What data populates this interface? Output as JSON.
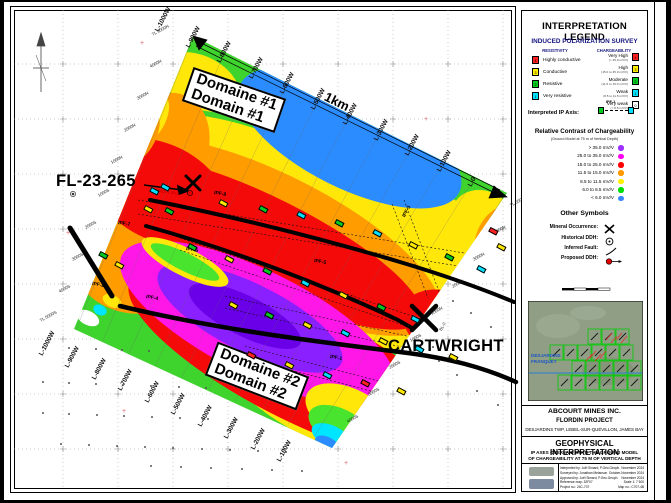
{
  "map": {
    "labels": {
      "drillhole": "FL-23-265",
      "cartwright": "CARTWRIGHT",
      "occurrence": "FLORDIN (Au)",
      "scale": "1km",
      "baseline": "BL-0",
      "domain1": {
        "line1": "Domaine #1",
        "line2": "Domain #1"
      },
      "domain2": {
        "line1": "Domaine #2",
        "line2": "Domain #2"
      }
    },
    "lines_top": [
      {
        "t": "L-1000W",
        "x": 160,
        "y": 26
      },
      {
        "t": "L-900W",
        "x": 191,
        "y": 42
      },
      {
        "t": "L-800W",
        "x": 222,
        "y": 57
      },
      {
        "t": "L-700W",
        "x": 254,
        "y": 73
      },
      {
        "t": "L-600W",
        "x": 285,
        "y": 88
      },
      {
        "t": "L-500W",
        "x": 316,
        "y": 104
      },
      {
        "t": "L-400W",
        "x": 348,
        "y": 119
      },
      {
        "t": "L-300W",
        "x": 379,
        "y": 135
      },
      {
        "t": "L-200W",
        "x": 410,
        "y": 150
      },
      {
        "t": "L-100W",
        "x": 442,
        "y": 166
      },
      {
        "t": "L-0",
        "x": 473,
        "y": 181
      }
    ],
    "lines_bottom": [
      {
        "t": "L-1000W",
        "x": 44,
        "y": 350
      },
      {
        "t": "L-900W",
        "x": 70,
        "y": 362
      },
      {
        "t": "L-800W",
        "x": 97,
        "y": 374
      },
      {
        "t": "L-700W",
        "x": 123,
        "y": 385
      },
      {
        "t": "L-600W",
        "x": 150,
        "y": 397
      },
      {
        "t": "L-500W",
        "x": 176,
        "y": 409
      },
      {
        "t": "L-400W",
        "x": 203,
        "y": 421
      },
      {
        "t": "L-300W",
        "x": 229,
        "y": 433
      },
      {
        "t": "L-200W",
        "x": 256,
        "y": 444
      },
      {
        "t": "L-100W",
        "x": 282,
        "y": 456
      }
    ],
    "stations_west": [
      {
        "t": "TL 5000N",
        "x": 152,
        "y": 32
      },
      {
        "t": "4000N",
        "x": 150,
        "y": 64
      },
      {
        "t": "3000N",
        "x": 137,
        "y": 96
      },
      {
        "t": "2000N",
        "x": 124,
        "y": 128
      },
      {
        "t": "1000N",
        "x": 111,
        "y": 160
      },
      {
        "t": "1000S",
        "x": 98,
        "y": 193
      },
      {
        "t": "2000S",
        "x": 85,
        "y": 225
      },
      {
        "t": "3000S",
        "x": 72,
        "y": 257
      },
      {
        "t": "4000S",
        "x": 59,
        "y": 289
      },
      {
        "t": "TL 5000S",
        "x": 40,
        "y": 318
      }
    ],
    "stations_east": [
      {
        "t": "TL 5000N",
        "x": 510,
        "y": 203
      },
      {
        "t": "4000N",
        "x": 494,
        "y": 230
      },
      {
        "t": "3000N",
        "x": 473,
        "y": 257
      },
      {
        "t": "2000N",
        "x": 452,
        "y": 284
      },
      {
        "t": "1000N",
        "x": 431,
        "y": 311
      },
      {
        "t": "1000S",
        "x": 410,
        "y": 338
      },
      {
        "t": "2000S",
        "x": 389,
        "y": 365
      },
      {
        "t": "3000S",
        "x": 368,
        "y": 392
      },
      {
        "t": "4000S",
        "x": 347,
        "y": 419
      }
    ],
    "ipf_labels": [
      {
        "t": "IPF-8",
        "x": 214,
        "y": 190,
        "r": 10
      },
      {
        "t": "IPF-7",
        "x": 118,
        "y": 220,
        "r": 10
      },
      {
        "t": "IPF-6",
        "x": 186,
        "y": 246,
        "r": 10
      },
      {
        "t": "IPF-5",
        "x": 314,
        "y": 258,
        "r": 10
      },
      {
        "t": "IPF-4",
        "x": 146,
        "y": 294,
        "r": 10
      },
      {
        "t": "IPF-3",
        "x": 404,
        "y": 214,
        "r": -62
      },
      {
        "t": "IPF-2",
        "x": 92,
        "y": 281,
        "r": 10
      },
      {
        "t": "IPF-1",
        "x": 330,
        "y": 354,
        "r": 10
      }
    ],
    "chip_colors": {
      "g": "#00CC22",
      "c": "#00E0FF",
      "y": "#FFEA00",
      "r": "#FF2222"
    },
    "chips": [
      [
        152,
        187,
        "c"
      ],
      [
        163,
        183,
        "c"
      ],
      [
        146,
        205,
        "y"
      ],
      [
        167,
        207,
        "g"
      ],
      [
        221,
        199,
        "y"
      ],
      [
        261,
        205,
        "g"
      ],
      [
        299,
        211,
        "c"
      ],
      [
        337,
        219,
        "g"
      ],
      [
        375,
        229,
        "c"
      ],
      [
        411,
        241,
        "y"
      ],
      [
        447,
        253,
        "g"
      ],
      [
        479,
        265,
        "c"
      ],
      [
        190,
        243,
        "g"
      ],
      [
        227,
        255,
        "y"
      ],
      [
        265,
        267,
        "g"
      ],
      [
        303,
        279,
        "c"
      ],
      [
        341,
        291,
        "y"
      ],
      [
        379,
        303,
        "g"
      ],
      [
        413,
        315,
        "c"
      ],
      [
        231,
        301,
        "y"
      ],
      [
        267,
        311,
        "g"
      ],
      [
        305,
        321,
        "y"
      ],
      [
        343,
        329,
        "c"
      ],
      [
        381,
        337,
        "y"
      ],
      [
        417,
        345,
        "c"
      ],
      [
        451,
        353,
        "y"
      ],
      [
        249,
        351,
        "r"
      ],
      [
        287,
        361,
        "y"
      ],
      [
        325,
        371,
        "c"
      ],
      [
        363,
        379,
        "r"
      ],
      [
        399,
        387,
        "y"
      ],
      [
        491,
        227,
        "r"
      ],
      [
        499,
        243,
        "y"
      ],
      [
        117,
        261,
        "y"
      ],
      [
        101,
        251,
        "g"
      ]
    ],
    "ddh_dots": [
      [
        42,
        346
      ],
      [
        68,
        347
      ],
      [
        95,
        348
      ],
      [
        121,
        349
      ],
      [
        148,
        350
      ],
      [
        42,
        381
      ],
      [
        68,
        382
      ],
      [
        95,
        383
      ],
      [
        122,
        384
      ],
      [
        150,
        385
      ],
      [
        178,
        386
      ],
      [
        205,
        387
      ],
      [
        42,
        412
      ],
      [
        68,
        413
      ],
      [
        96,
        414
      ],
      [
        123,
        415
      ],
      [
        151,
        416
      ],
      [
        179,
        417
      ],
      [
        207,
        418
      ],
      [
        234,
        419
      ],
      [
        60,
        443
      ],
      [
        88,
        444
      ],
      [
        116,
        445
      ],
      [
        144,
        446
      ],
      [
        172,
        447
      ],
      [
        201,
        448
      ],
      [
        229,
        449
      ],
      [
        257,
        450
      ],
      [
        285,
        451
      ],
      [
        150,
        465
      ],
      [
        180,
        466
      ],
      [
        210,
        467
      ],
      [
        241,
        468
      ],
      [
        271,
        469
      ],
      [
        301,
        470
      ],
      [
        438,
        360
      ],
      [
        456,
        374
      ],
      [
        476,
        390
      ],
      [
        497,
        404
      ],
      [
        432,
        346
      ],
      [
        452,
        300
      ],
      [
        470,
        312
      ],
      [
        490,
        326
      ]
    ],
    "red_crosses": [
      [
        140,
        42
      ],
      [
        424,
        118
      ],
      [
        66,
        232
      ],
      [
        122,
        410
      ],
      [
        344,
        462
      ]
    ]
  },
  "legend": {
    "title": "INTERPRETATION LEGEND",
    "ip_survey": {
      "heading": "INDUCED POLARIZATION SURVEY",
      "col_resistivity": "RESISTIVITY",
      "col_chargeability": "CHARGEABILITY",
      "resistivity": [
        {
          "code": "4",
          "color": "#FF2020",
          "label": "Highly conductive"
        },
        {
          "code": "3",
          "color": "#FFEE00",
          "label": "Conductive"
        },
        {
          "code": "2",
          "color": "#00CC22",
          "label": "Resistive"
        },
        {
          "code": "1",
          "color": "#00E0FF",
          "label": "Very resistive"
        }
      ],
      "chargeability": [
        {
          "code": "4",
          "color": "#FF2020",
          "label": "Very High",
          "caption": "(> 35.0 mV/V)"
        },
        {
          "code": "3",
          "color": "#FFEE00",
          "label": "High",
          "caption": "(15.0 to 35.0 mV/V)"
        },
        {
          "code": "2",
          "color": "#00CC22",
          "label": "Moderate",
          "caption": "(11.5 to 15.0 mV/V)"
        },
        {
          "code": "1",
          "color": "#00E0FF",
          "label": "Weak",
          "caption": "(8.5 to 11.5 mV/V)"
        },
        {
          "code": "0",
          "color": "#FFFFFF",
          "label": "Very weak",
          "caption": "(< 8.5 mV/V)"
        }
      ],
      "ip_axis_label": "Interpreted IP Axis:",
      "ip_axis_tag": "IPF-1"
    },
    "contrast": {
      "title": "Relative Contrast of Chargeability",
      "subtitle": "(Ground Model at 75 m of Vertical Depth)",
      "rows": [
        {
          "label": "> 35.0 mV/V",
          "color": "#9B30FF"
        },
        {
          "label": "25.0 to 35.0 mV/V",
          "color": "#FF00F0"
        },
        {
          "label": "15.0 to 25.0 mV/V",
          "color": "#FF0000"
        },
        {
          "label": "11.5 to 15.0 mV/V",
          "color": "#FF9900"
        },
        {
          "label": "8.5 to 11.5 mV/V",
          "color": "#FFEE00"
        },
        {
          "label": "6.0 to 8.5 mV/V",
          "color": "#00DD00"
        },
        {
          "label": "< 6.0 mV/V",
          "color": "#3A86FF"
        }
      ]
    },
    "symbols": {
      "title": "Other Symbols",
      "rows": [
        "Mineral Occurrence:",
        "Historical DDH:",
        "Inferred Fault:",
        "Proposed DDH:"
      ]
    },
    "inset": {
      "label1": "DESJARDINS",
      "label2": "FRANQUET"
    }
  },
  "titleblock": {
    "company": "ABCOURT MINES INC.",
    "project": "FLORDIN PROJECT",
    "location": "DESJARDINS TWP, LEBEL-SUR-QUÉVILLON, JAMES BAY",
    "title": "GEOPHYSICAL INTERPRETATION",
    "subtitle1": "IP AXES OVERLAID ONTO THE GROUND MODEL",
    "subtitle2": "OF CHARGEABILITY AT 75 M OF VERTICAL DEPTH",
    "credits": [
      [
        "Interpreted by:",
        "Joël Simard, P.Geo.Geoph.",
        "November 2024"
      ],
      [
        "Surveyed by:",
        "Jonathan Melanson",
        "October-November 2024"
      ],
      [
        "Approved by:",
        "Joël Simard, P.Geo.Geoph.",
        "November 2024"
      ],
      [
        "Reference map:",
        "32F07",
        "Scale 1: 7 500"
      ],
      [
        "Project no.:",
        "24C-707",
        "Map no.: C707-4B"
      ]
    ]
  }
}
